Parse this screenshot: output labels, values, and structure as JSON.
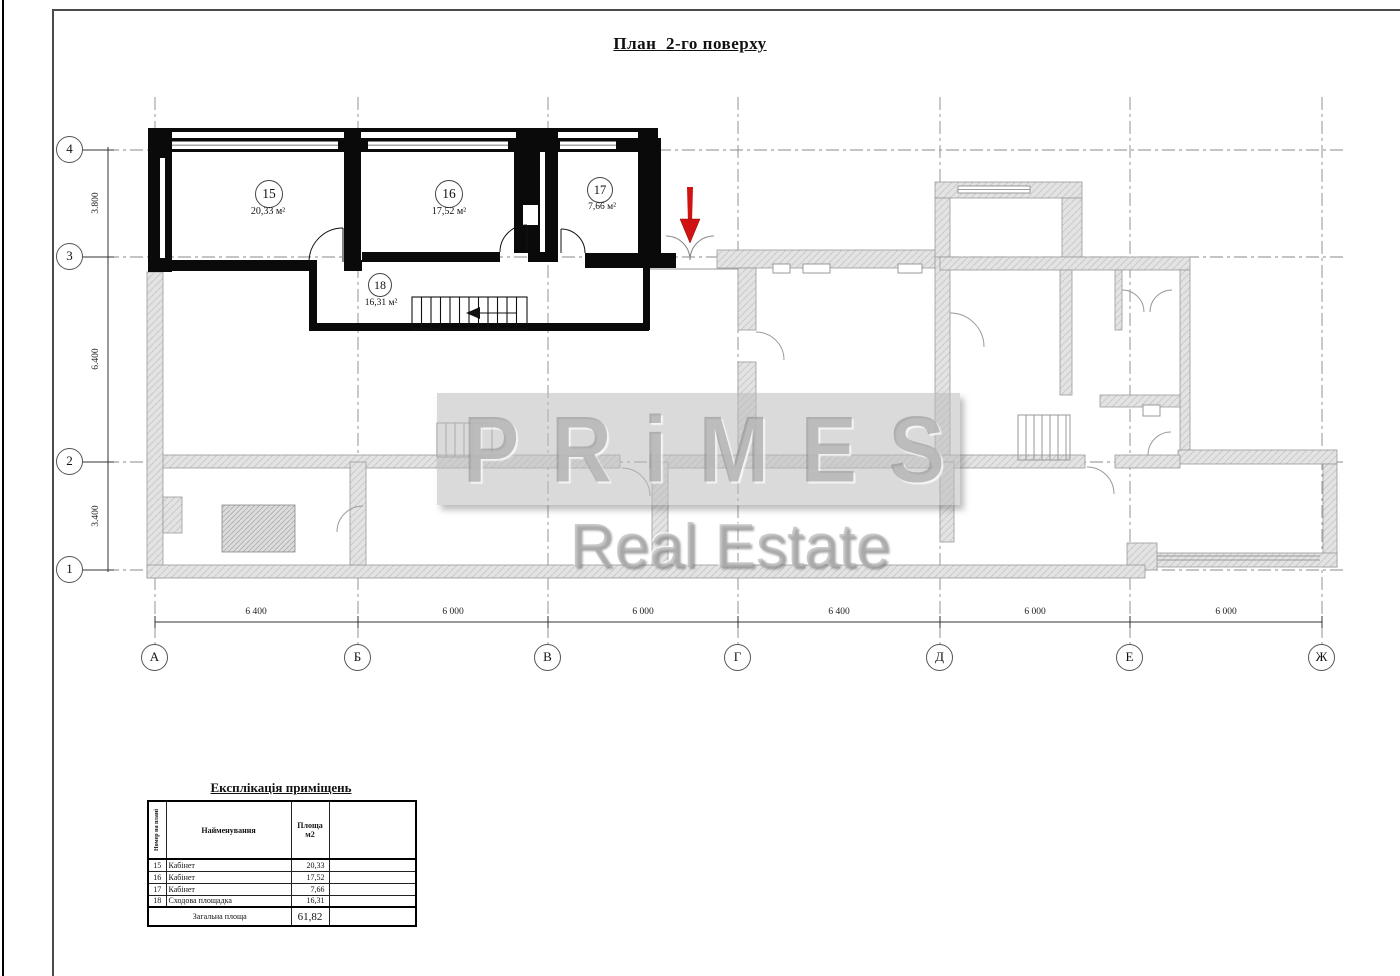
{
  "title": "План  2-го поверху",
  "plan": {
    "rooms": [
      {
        "number": "15",
        "area": "20,33 м²"
      },
      {
        "number": "16",
        "area": "17,52 м²"
      },
      {
        "number": "17",
        "area": "7,66 м²"
      },
      {
        "number": "18",
        "area": "16,31 м²"
      }
    ],
    "axes_horizontal": {
      "labels": [
        "А",
        "Б",
        "В",
        "Г",
        "Д",
        "Е",
        "Ж"
      ],
      "dimensions": [
        "6 400",
        "6 000",
        "6 000",
        "6 400",
        "6 000",
        "6 000"
      ]
    },
    "axes_vertical": {
      "labels": [
        "4",
        "3",
        "2",
        "1"
      ],
      "dimensions": [
        "3.800",
        "6.400",
        "3.400"
      ]
    }
  },
  "watermark": {
    "line1": "PRiMES",
    "line2": "Real Estate"
  },
  "legend_table": {
    "title": "Експлікація приміщень",
    "columns": [
      "Номер на плані",
      "Найменування",
      "Площа\nм2"
    ],
    "rows": [
      [
        "15",
        "Кабінет",
        "20,33"
      ],
      [
        "16",
        "Кабінет",
        "17,52"
      ],
      [
        "17",
        "Кабінет",
        "7,66"
      ],
      [
        "18",
        "Сходова площадка",
        "16,31"
      ]
    ],
    "footer": {
      "label": "Загальна площа",
      "value": "61,82"
    }
  },
  "colors": {
    "wall_black": "#0a0a0a",
    "wall_gray": "#e0e0e0",
    "accent_red": "#cf1212",
    "grid": "#8a8a8a"
  }
}
